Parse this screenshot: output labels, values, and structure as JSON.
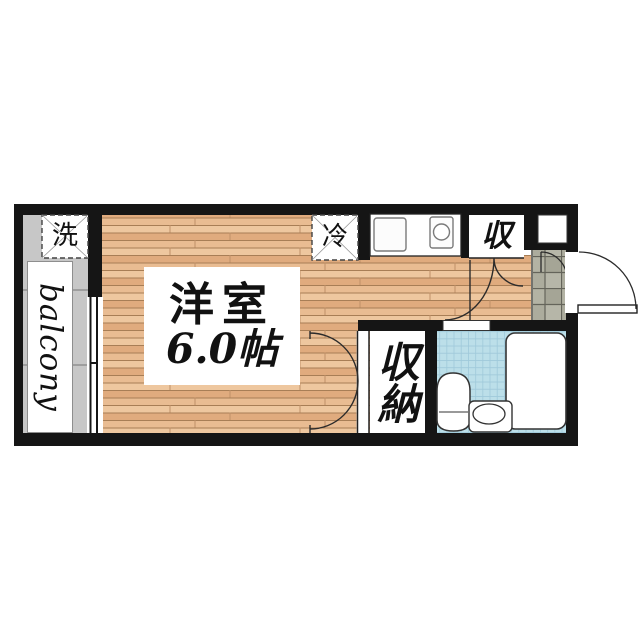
{
  "floor_plan": {
    "balcony_label": "balcony",
    "washer_label": "洗",
    "room_name": "洋室",
    "room_size": "6.0帖",
    "fridge_label": "冷",
    "upper_storage_label": "収",
    "closet_label": "収納",
    "colors": {
      "wall": "#151515",
      "wood_floor_light": "#eec79f",
      "wood_floor_mid": "#e0ab7e",
      "wood_floor_dark": "#e9bc92",
      "wood_seam": "#a87e56",
      "balcony_gray": "#c7c7c7",
      "genkan_tile": "#acac9d",
      "tile_grout": "#64645a",
      "bathroom_tile": "#bcdfe9",
      "bathroom_grid": "#9fc9da",
      "fixture_outline": "#333333",
      "label_text": "#111111"
    }
  }
}
